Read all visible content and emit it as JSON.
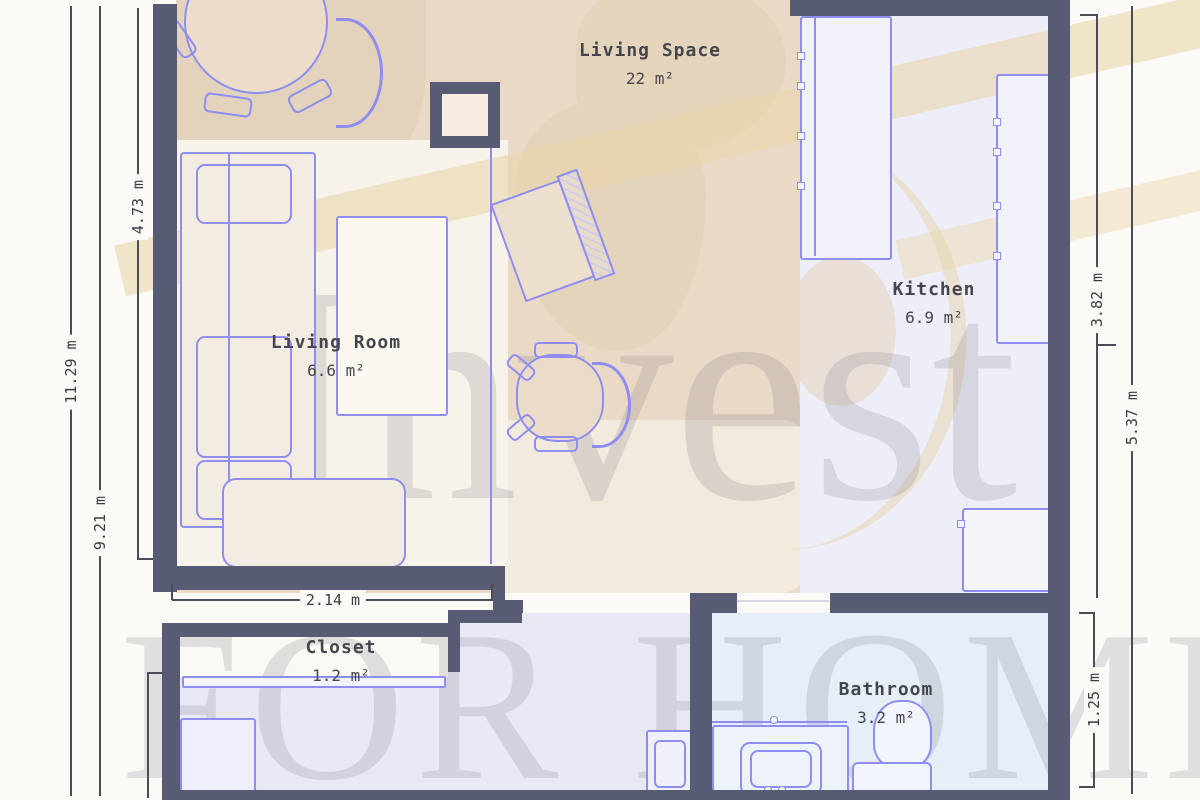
{
  "page": {
    "type": "floor-plan-screenshot",
    "background": "#fbfaf6"
  },
  "watermark": {
    "brand_top": "Invest",
    "brand_bottom": "FOR HOME"
  },
  "rooms": [
    {
      "name": "Living Space",
      "area": "22 m²"
    },
    {
      "name": "Living Room",
      "area": "6.6 m²"
    },
    {
      "name": "Kitchen",
      "area": "6.9 m²"
    },
    {
      "name": "Closet",
      "area": "1.2 m²"
    },
    {
      "name": "Bathroom",
      "area": "3.2 m²"
    }
  ],
  "dimensions": {
    "left_outer": "11.29 m",
    "left_middle": "9.21 m",
    "left_inner": "4.73 m",
    "bottom": "2.14 m",
    "right_inner_top": "3.82 m",
    "right_outer": "5.37 m",
    "right_inner_bottom": "1.25 m"
  },
  "colors": {
    "wall": "#575b73",
    "furniture_outline": "#8f8ef0",
    "dimension_line": "#4a4d57",
    "floor_living_space": "#ead9c6",
    "floor_living_room": "#f7f2ea",
    "floor_kitchen": "#eeeef9",
    "floor_hall": "#e9e9f6",
    "floor_closet": "#e9e9f6",
    "floor_bathroom": "#e6eef8"
  }
}
